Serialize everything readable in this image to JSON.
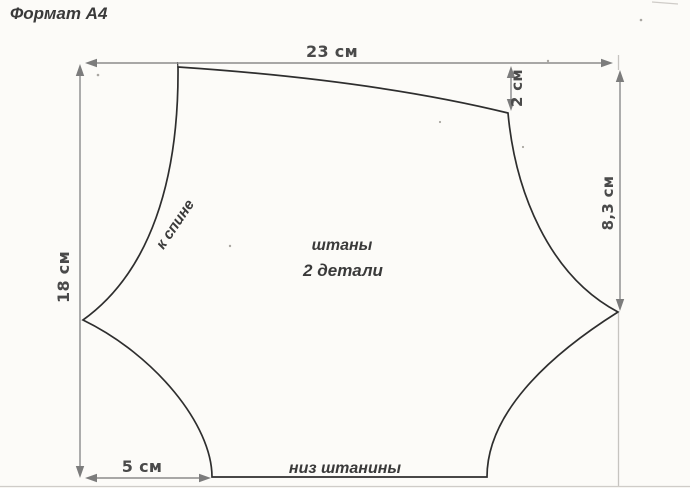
{
  "sheet": {
    "format_label": "Формат А4"
  },
  "pattern": {
    "title": "штаны",
    "subtitle": "2 детали",
    "back_edge_label": "к спине",
    "hem_edge_label": "низ штанины"
  },
  "dimensions": {
    "top_width": "23 см",
    "left_height": "18 см",
    "right_top_drop": "2 см",
    "right_side_depth": "8,3 см",
    "bottom_left_inset": "5 см"
  },
  "colors": {
    "pattern_outline": "#2e2e2e",
    "dimension_lines": "#8b8b8b",
    "label_text": "#3a3a3a",
    "paper_background": "#fcfbf8"
  }
}
